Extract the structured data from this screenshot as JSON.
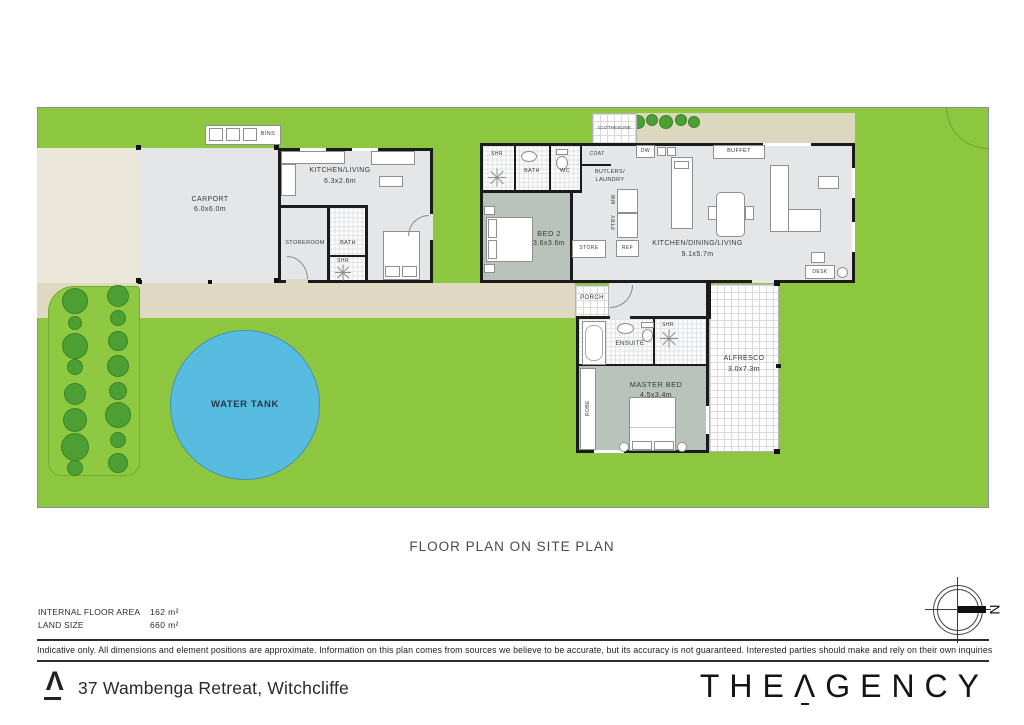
{
  "title": "FLOOR PLAN ON SITE PLAN",
  "colors": {
    "lawn": "#8dc63f",
    "tree": "#4d9e33",
    "path": "#dfd9c4",
    "driveway": "#ebe8db",
    "garden_strip": "#dcd7bf",
    "floor": "#e5e6e8",
    "bedroom_floor": "#b9c3bb",
    "water": "#58bce0",
    "wall": "#1b1b1b"
  },
  "site": {
    "water_tank_label": "WATER TANK",
    "clothesline_label": "CLOTHESLINE",
    "bins_label": "BINS",
    "trees": [
      [
        75,
        301,
        13
      ],
      [
        75,
        323,
        7
      ],
      [
        75,
        346,
        13
      ],
      [
        75,
        367,
        8
      ],
      [
        75,
        394,
        11
      ],
      [
        75,
        420,
        12
      ],
      [
        75,
        447,
        14
      ],
      [
        75,
        468,
        8
      ],
      [
        118,
        296,
        11
      ],
      [
        118,
        318,
        8
      ],
      [
        118,
        341,
        10
      ],
      [
        118,
        366,
        11
      ],
      [
        118,
        391,
        9
      ],
      [
        118,
        415,
        13
      ],
      [
        118,
        440,
        8
      ],
      [
        118,
        463,
        10
      ]
    ],
    "bushes": [
      [
        638,
        122,
        7
      ],
      [
        652,
        120,
        6
      ],
      [
        666,
        122,
        7
      ],
      [
        681,
        120,
        6
      ],
      [
        694,
        122,
        6
      ]
    ]
  },
  "rooms": {
    "carport": {
      "name": "CARPORT",
      "dims": "6.0x6.0m"
    },
    "kitchen_living": {
      "name": "KITCHEN/LIVING",
      "dims": "6.3x2.6m"
    },
    "storeroom": "STOREROOM",
    "bath1": "BATH",
    "shr1": "SHR",
    "shr2": "SHR",
    "bath2": "BATH",
    "wc": "WC",
    "coat": "COAT",
    "butlers_line1": "BUTLERS/",
    "butlers_line2": "LAUNDRY",
    "bed2": {
      "name": "BED 2",
      "dims": "3.6x3.6m"
    },
    "store": "STORE",
    "ptry": "PTRY",
    "mw": "MW",
    "ref": "REF",
    "dw": "DW",
    "buffet": "BUFFET",
    "kdl": {
      "name": "KITCHEN/DINING/LIVING",
      "dims": "9.1x5.7m"
    },
    "desk": "DESK",
    "porch": "PORCH",
    "ensuite": "ENSUITE",
    "shr3": "SHR",
    "robe": "ROBE",
    "master": {
      "name": "MASTER BED",
      "dims": "4.5x3.4m"
    },
    "alfresco": {
      "name": "ALFRESCO",
      "dims": "3.0x7.3m"
    }
  },
  "compass": {
    "north": "N"
  },
  "footer": {
    "area_label": "INTERNAL FLOOR AREA",
    "area_value": "162 m²",
    "land_label": "LAND SIZE",
    "land_value": "660 m²",
    "disclaimer": "Indicative only. All dimensions and element positions are approximate. Information on this plan comes from sources we believe to be accurate, but its accuracy is not guaranteed. Interested parties should make and rely on their own inquiries",
    "address": "37 Wambenga Retreat, Witchcliffe",
    "brand_the": "THE",
    "brand_a": "Λ",
    "brand_rest": "GENCY",
    "logo_mark": "Λ"
  }
}
